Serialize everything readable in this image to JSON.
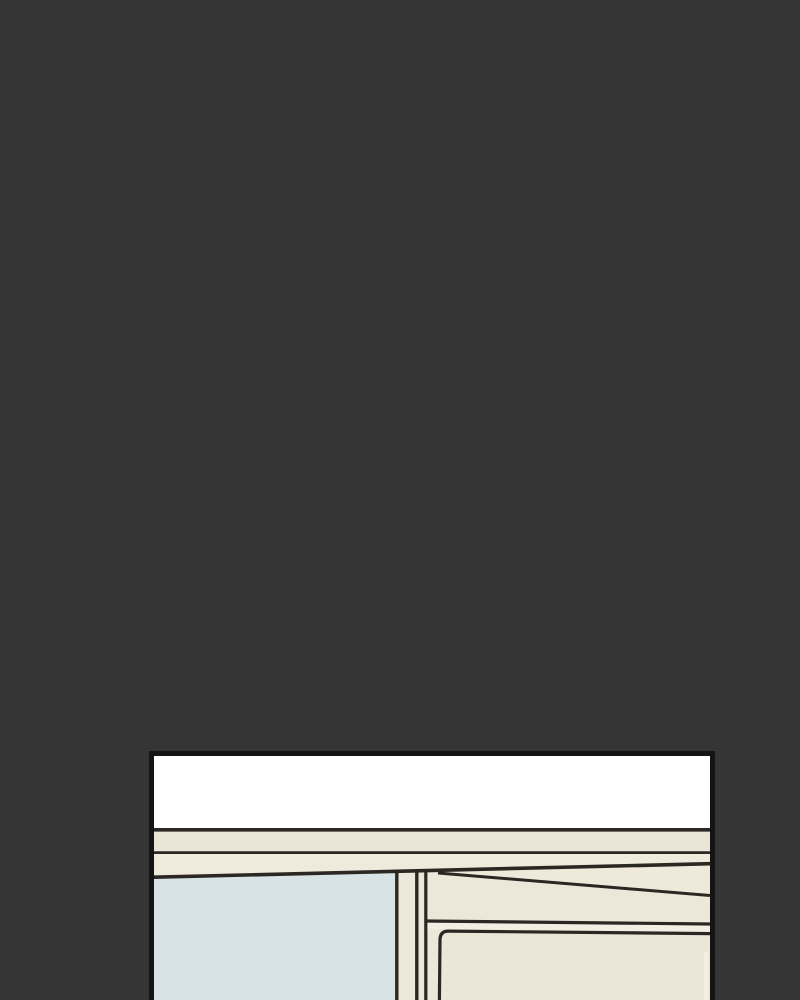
{
  "page": {
    "type": "webtoon-reader",
    "background_color": "#353535"
  },
  "panel": {
    "name": "comic-panel-partial",
    "description": "Top portion of a comic panel scrolled into view: white ceiling strip, two cream wall-trim bands, pale-blue window pane on the left, cream kitchen cabinet with drawer front on the right; panel is cut off by the bottom of the viewport",
    "border_color": "#141414",
    "palette": {
      "ink": "#2b2722",
      "ceiling_white": "#ffffff",
      "trim_band_upper": "#eae5d6",
      "trim_band_lower": "#efeadc",
      "window_blue": "#d7e3e4",
      "mullion_cream": "#ece8d9",
      "cabinet_cream": "#ece7d8",
      "cabinet_top_cream": "#eee9da",
      "drawer_gap_cream": "#f2eee1",
      "drawer_face_cream": "#ebe6d8",
      "edge_highlight": "#f5f1e6"
    },
    "regions": [
      "ceiling",
      "trim-band-upper",
      "trim-band-lower",
      "window-pane",
      "window-mullion",
      "cabinet",
      "cabinet-top-surface",
      "drawer-gap",
      "drawer-front"
    ]
  }
}
